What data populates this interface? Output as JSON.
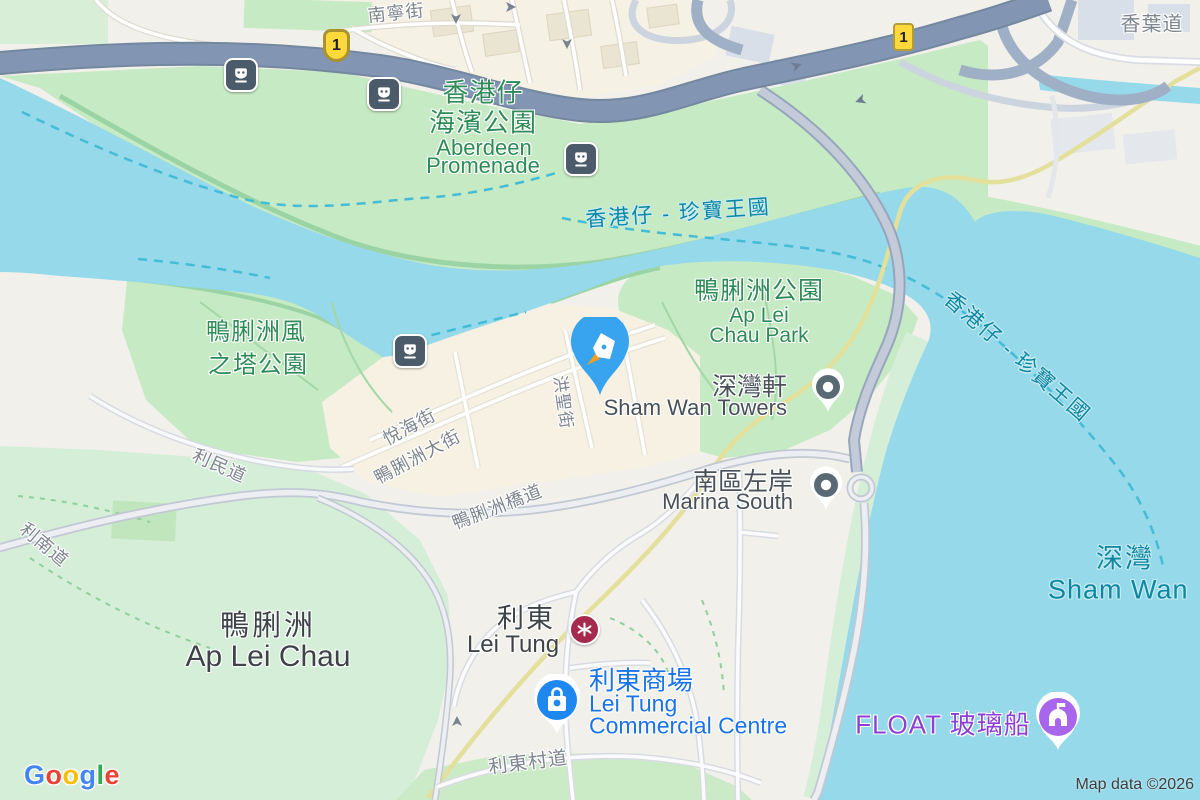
{
  "map": {
    "attribution": "Map data ©2026",
    "route_shield": "1",
    "logo_letters": {
      "l1": "G",
      "l2": "o",
      "l3": "o",
      "l4": "g",
      "l5": "l",
      "l6": "e"
    }
  },
  "labels": {
    "nam_ning_street": "南寧街",
    "hong_yip_road": "香葉道",
    "promenade_zh1": "香港仔",
    "promenade_zh2": "海濱公園",
    "promenade_en1": "Aberdeen",
    "promenade_en2": "Promenade",
    "ferry_route": "香港仔 - 珍寶王國",
    "alc_park_zh": "鴨脷洲公園",
    "alc_park_en1": "Ap Lei",
    "alc_park_en2": "Chau Park",
    "sham_wan_towers_zh": "深灣軒",
    "sham_wan_towers_en": "Sham Wan Towers",
    "marina_south_zh": "南區左岸",
    "marina_south_en": "Marina South",
    "wind_tower_zh1": "鴨脷洲風",
    "wind_tower_zh2": "之塔公園",
    "yuet_hoi_street": "悅海街",
    "main_street": "鴨脷洲大街",
    "hung_shing_street": "洪聖街",
    "lee_man_road": "利民道",
    "bridge_road": "鴨脷洲橋道",
    "lee_nam_road": "利南道",
    "ap_lei_chau_zh": "鴨脷洲",
    "ap_lei_chau_en": "Ap Lei Chau",
    "lei_tung_zh": "利東",
    "lei_tung_en": "Lei Tung",
    "lt_commercial_zh": "利東商場",
    "lt_commercial_en1": "Lei Tung",
    "lt_commercial_en2": "Commercial Centre",
    "lei_tung_estate_road": "利東村道",
    "float_boat": "FLOAT 玻璃船",
    "sham_wan_zh": "深灣",
    "sham_wan_en": "Sham Wan"
  },
  "icons": [
    "ferry-station-icon",
    "mtr-station-icon",
    "route-1-shield",
    "selected-place-pin",
    "pen-nib-icon",
    "poi-dot-pin",
    "shopping-bag-pin",
    "attraction-landmark-pin",
    "one-way-arrow-icon",
    "google-logo"
  ],
  "colors": {
    "water": "#95D9EA",
    "land": "#F1F0EB",
    "park_green": "#C6EAC3",
    "hill_green": "#D5EED8",
    "urban_beige": "#F6F1E2",
    "highway": "#7E93B4",
    "bridge": "#C3CBD8",
    "rail_line": "#E3E09C",
    "ferry_route_dash": "#44BCD6",
    "park_label": "#2E8B57",
    "water_label": "#0E87A0",
    "street_label": "#7F858E",
    "poi_blue": "#1A73E8",
    "poi_purple": "#8D3FD3",
    "mtr_red": "#A62A4D",
    "shield_yellow": "#FFD83B",
    "selected_pin_blue": "#38A3EE",
    "pen_tip_orange": "#F59E1B",
    "gray_pin": "#5A6A75",
    "google_blue": "#4285F4",
    "google_red": "#EA4335",
    "google_yellow": "#FBBC05",
    "google_green": "#34A853"
  }
}
